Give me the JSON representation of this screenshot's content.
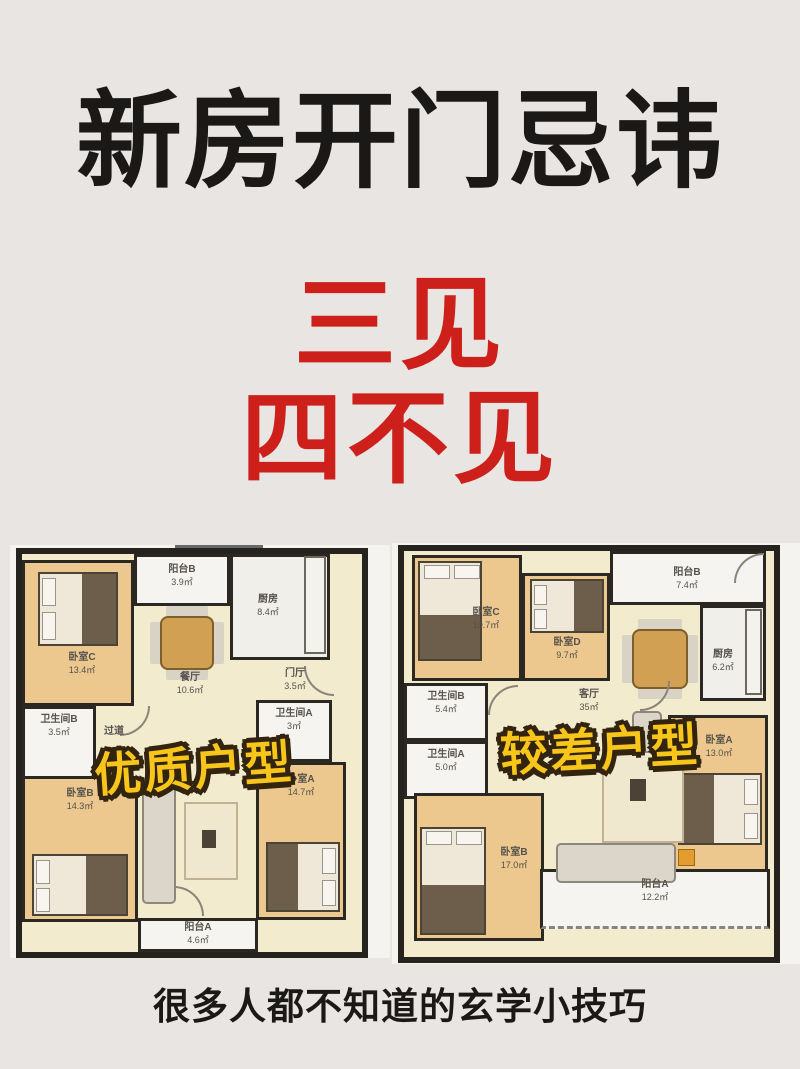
{
  "page": {
    "title": "新房开门忌讳",
    "subtitle_line1": "三见",
    "subtitle_line2": "四不见",
    "footer": "很多人都不知道的玄学小技巧",
    "colors": {
      "background": "#e9e5e2",
      "headline": "#1b1917",
      "accent_red": "#cd201b",
      "overlay_yellow": "#f8c61a",
      "overlay_outline": "#32240f",
      "wall": "#26221e",
      "bedroom_fill": "#ecc88f",
      "living_fill": "#f3ebce",
      "white_room_fill": "#f6f4f0"
    }
  },
  "plans": [
    {
      "id": "good",
      "overlay_label": "优质户型",
      "rooms": [
        {
          "name": "卧室C",
          "area": "13.4㎡"
        },
        {
          "name": "阳台B",
          "area": "3.9㎡"
        },
        {
          "name": "餐厅",
          "area": "10.6㎡"
        },
        {
          "name": "厨房",
          "area": "8.4㎡"
        },
        {
          "name": "门厅",
          "area": "3.5㎡"
        },
        {
          "name": "卫生间B",
          "area": "3.5㎡"
        },
        {
          "name": "过道",
          "area": ""
        },
        {
          "name": "卫生间A",
          "area": "3㎡"
        },
        {
          "name": "卧室B",
          "area": "14.3㎡"
        },
        {
          "name": "卧室A",
          "area": "14.7㎡"
        },
        {
          "name": "阳台A",
          "area": "4.6㎡"
        }
      ]
    },
    {
      "id": "bad",
      "overlay_label": "较差户型",
      "rooms": [
        {
          "name": "卧室C",
          "area": "10.7㎡"
        },
        {
          "name": "卧室D",
          "area": "9.7㎡"
        },
        {
          "name": "阳台B",
          "area": "7.4㎡"
        },
        {
          "name": "厨房",
          "area": "6.2㎡"
        },
        {
          "name": "卫生间B",
          "area": "5.4㎡"
        },
        {
          "name": "卫生间A",
          "area": "5.0㎡"
        },
        {
          "name": "客厅",
          "area": "35㎡"
        },
        {
          "name": "卧室A",
          "area": "13.0㎡"
        },
        {
          "name": "卧室B",
          "area": "17.0㎡"
        },
        {
          "name": "阳台A",
          "area": "12.2㎡"
        }
      ]
    }
  ]
}
